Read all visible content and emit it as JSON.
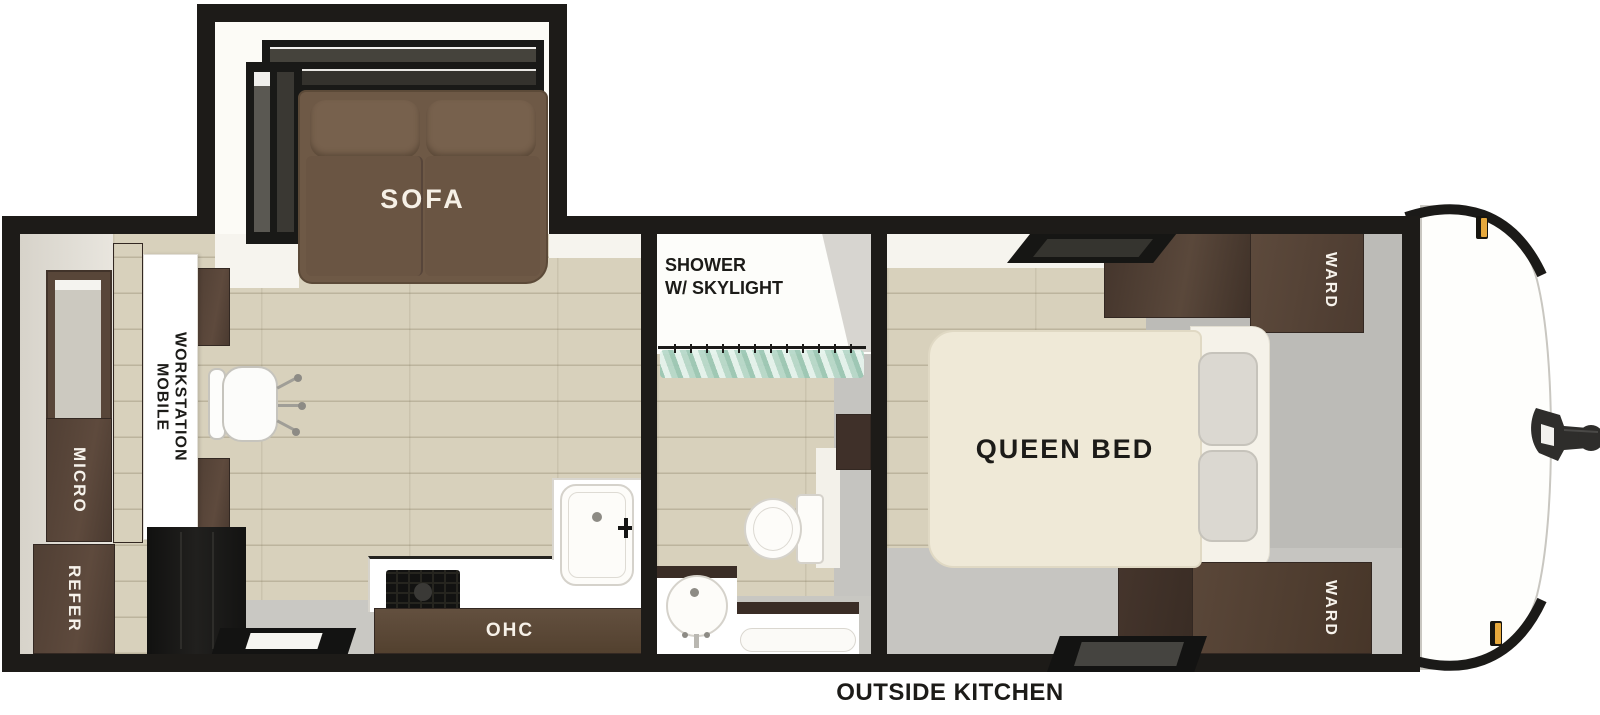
{
  "floorplan": {
    "slideout": {
      "sofa_label": "SOFA"
    },
    "living": {
      "workstation_label_line1": "MOBILE",
      "workstation_label_line2": "WORKSTATION",
      "micro_label": "MICRO",
      "refer_label": "REFER",
      "ohc_label": "OHC"
    },
    "bathroom": {
      "shower_label_line1": "SHOWER",
      "shower_label_line2": "W/ SKYLIGHT"
    },
    "bedroom": {
      "bed_label": "QUEEN BED",
      "ward_top_label": "WARD",
      "ward_bottom_label": "WARD"
    },
    "annotations": {
      "outside_kitchen_label": "OUTSIDE KITCHEN"
    },
    "colors": {
      "wall": "#1d1b18",
      "wood_floor": "#d8d1bc",
      "gray_floor": "#c2c1bd",
      "cabinet_brown": "#53423 7",
      "sofa_brown": "#6e5946",
      "bed_cream": "#efe9d7",
      "marker_light_orange": "#e6a83c",
      "curtain_green": "#b7d8c9"
    }
  }
}
